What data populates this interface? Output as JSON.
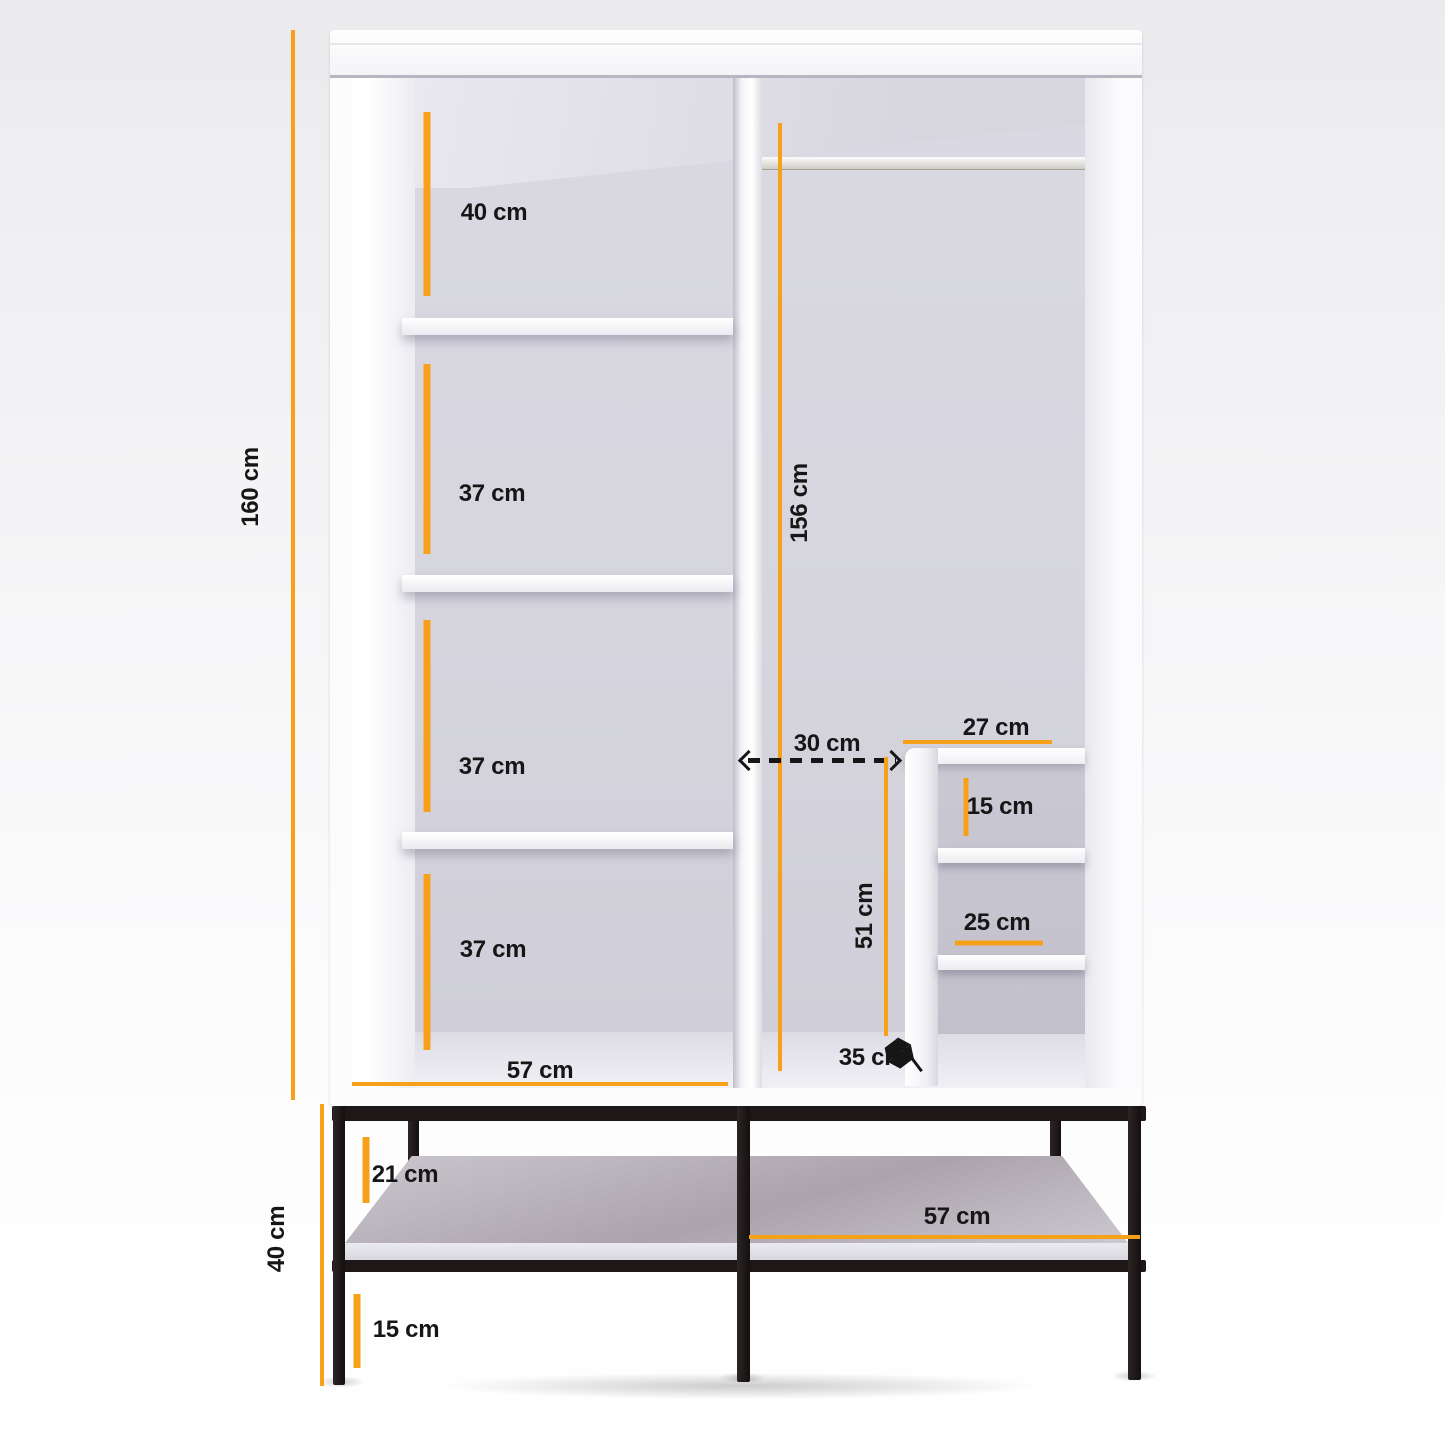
{
  "diagram": {
    "type": "furniture-dimension-diagram",
    "subject": "open wardrobe with shelves, hanging rail, cubby unit and black metal base",
    "unit": "cm",
    "colors": {
      "dimension_accent": "#F7A11B",
      "label_text": "#161616",
      "cabinet_white": "#FCFCFD",
      "interior_gray": "#D6D5DE",
      "base_metal_black": "#1D1817"
    }
  },
  "measurements": {
    "overall_height": {
      "label": "160 cm"
    },
    "top_compartment_height": {
      "label": "40 cm"
    },
    "compartment2_height": {
      "label": "37 cm"
    },
    "compartment3_height": {
      "label": "37 cm"
    },
    "compartment4_height": {
      "label": "37 cm"
    },
    "left_section_width": {
      "label": "57 cm"
    },
    "hanging_section_height": {
      "label": "156 cm"
    },
    "hanging_clearance": {
      "label": "30 cm"
    },
    "cubby_width": {
      "label": "27 cm"
    },
    "cubby_top_height": {
      "label": "15 cm"
    },
    "cubby_shelf_width": {
      "label": "25 cm"
    },
    "cubby_height": {
      "label": "51 cm"
    },
    "cubby_depth": {
      "label": "35 cm"
    },
    "base_top_clearance": {
      "label": "21 cm"
    },
    "base_shelf_width": {
      "label": "57 cm"
    },
    "base_bottom_clearance": {
      "label": "15 cm"
    },
    "base_height": {
      "label": "40 cm"
    }
  }
}
